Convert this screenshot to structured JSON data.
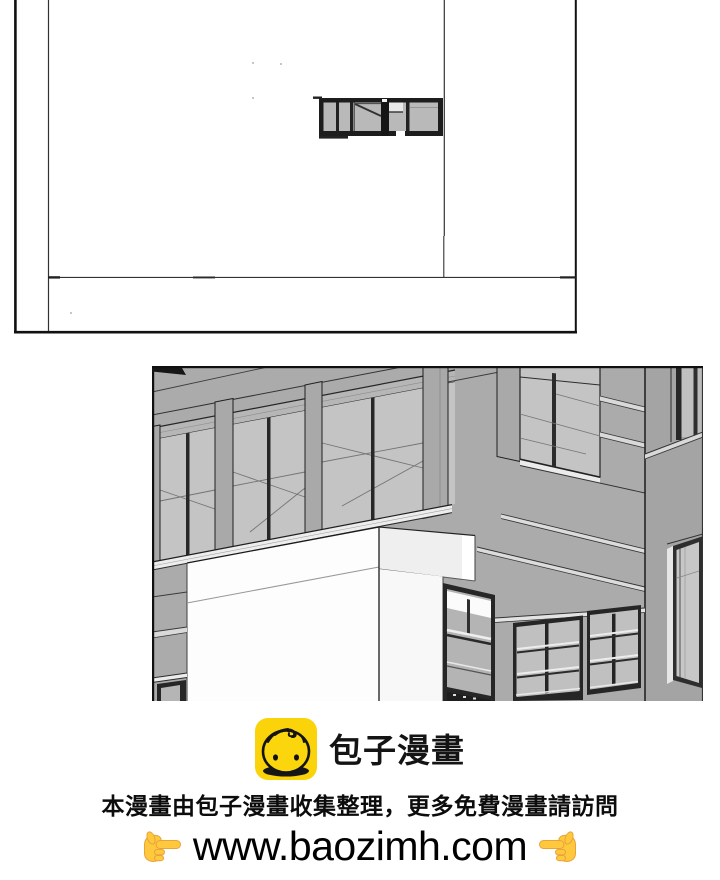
{
  "branding": {
    "logo_icon": "baozi-bun-icon",
    "brand_name": "包子漫畫",
    "brand_color": "#FBD30B"
  },
  "footer": {
    "notice": "本漫畫由包子漫畫收集整理，更多免費漫畫請訪問",
    "url": "www.baozimh.com",
    "left_hand_icon": "pointing-right-hand-icon",
    "right_hand_icon": "pointing-left-hand-icon"
  },
  "artwork": {
    "top_panel": "architectural-line-sketch",
    "middle_panel": "building-corner-3d-render",
    "facade_gray": "#ABABAB",
    "glass_gray": "#C4C4C4",
    "frame_dark": "#262626"
  }
}
